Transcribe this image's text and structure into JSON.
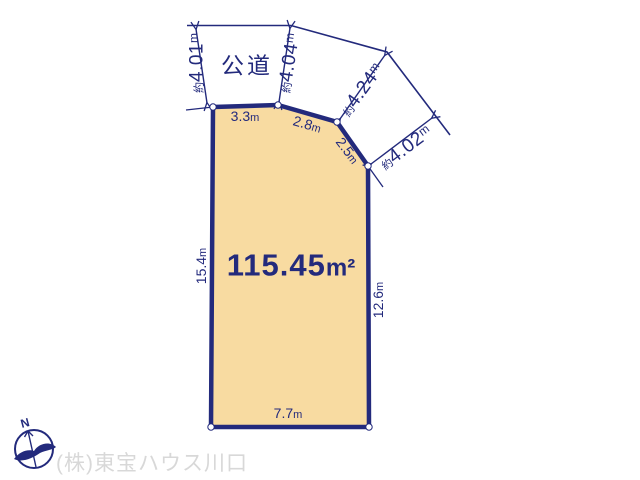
{
  "road": {
    "label": "公道",
    "widths": [
      {
        "prefix": "約",
        "value": "4.01",
        "unit": "m"
      },
      {
        "prefix": "約",
        "value": "4.04",
        "unit": "m"
      },
      {
        "prefix": "約",
        "value": "4.24",
        "unit": "m"
      },
      {
        "prefix": "約",
        "value": "4.02",
        "unit": "m"
      }
    ]
  },
  "plot": {
    "area": {
      "value": "115.45",
      "unit": "m²"
    },
    "edges": [
      {
        "name": "top-left",
        "value": "3.3",
        "unit": "m"
      },
      {
        "name": "top-middle",
        "value": "2.8",
        "unit": "m"
      },
      {
        "name": "top-right-diagonal",
        "value": "2.5",
        "unit": "m"
      },
      {
        "name": "left",
        "value": "15.4",
        "unit": "m"
      },
      {
        "name": "right",
        "value": "12.6",
        "unit": "m"
      },
      {
        "name": "bottom",
        "value": "7.7",
        "unit": "m"
      }
    ]
  },
  "compass": {
    "north": "N"
  },
  "watermark": {
    "company": "(株)東宝ハウス川口"
  },
  "colors": {
    "line": "#232a7c",
    "plot_fill": "#f8dba1",
    "vertex_fill": "#ffffff",
    "watermark": "#d8d8d8"
  }
}
